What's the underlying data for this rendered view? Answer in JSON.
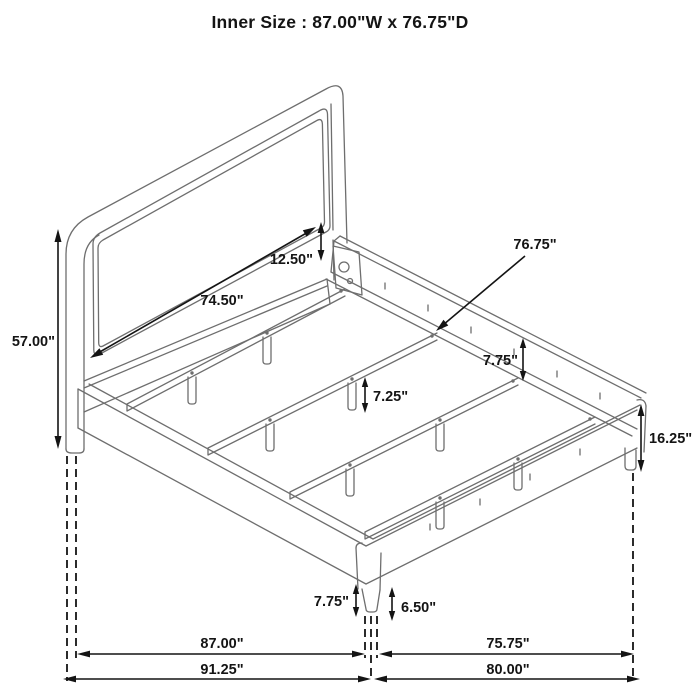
{
  "title": "Inner Size : 87.00\"W x 76.75\"D",
  "dimensions": {
    "headboard_height": "57.00\"",
    "headboard_panel_width": "74.50\"",
    "panel_to_rail": "12.50\"",
    "inner_depth": "76.75\"",
    "side_rail_height": "7.75\"",
    "center_support_leg_height": "7.25\"",
    "footboard_end_height": "16.25\"",
    "front_corner_section_height": "7.75\"",
    "front_leg_height": "6.50\"",
    "inner_width_floor": "87.00\"",
    "inner_depth_floor": "75.75\"",
    "outer_width_floor": "91.25\"",
    "outer_depth_floor": "80.00\""
  },
  "colors": {
    "line": "#6e6e6e",
    "dimension": "#141414",
    "background": "#ffffff"
  }
}
